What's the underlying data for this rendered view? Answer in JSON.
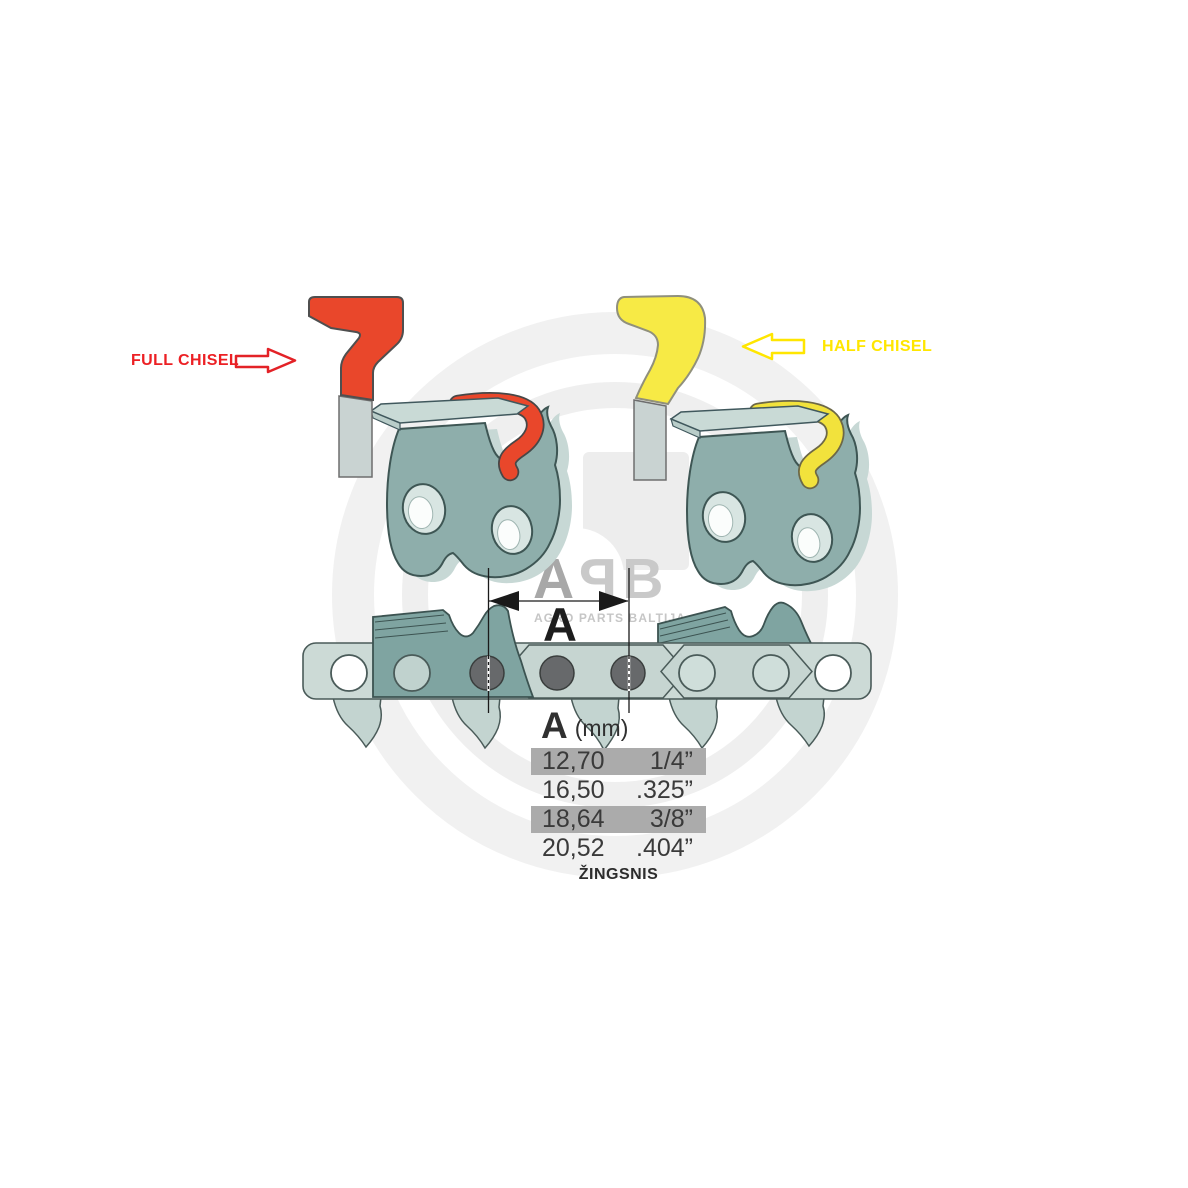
{
  "labels": {
    "full_chisel": "FULL CHISEL",
    "half_chisel": "HALF CHISEL",
    "dimension_letter": "A"
  },
  "pitch_table": {
    "header_symbol": "A",
    "header_unit": "(mm)",
    "rows": [
      {
        "mm": "12,70",
        "inch": "1/4”",
        "highlighted": true
      },
      {
        "mm": "16,50",
        "inch": ".325”",
        "highlighted": false
      },
      {
        "mm": "18,64",
        "inch": "3/8”",
        "highlighted": true
      },
      {
        "mm": "20,52",
        "inch": ".404”",
        "highlighted": false
      }
    ],
    "caption": "ŽINGSNIS"
  },
  "watermark": {
    "letters": [
      "A",
      "P",
      "B"
    ],
    "tagline": "AGRO PARTS BALTIJA"
  },
  "colors": {
    "full_chisel_red_text": "#EC2024",
    "chisel_red_fill": "#E9472B",
    "half_chisel_yellow_text": "#FFE600",
    "chisel_yellow_fill": "#F7EA45",
    "link_body_teal": "#8EAEAB",
    "chain_strap_teal": "#CCDAD6",
    "rivet_dark_gray": "#67696B",
    "row_highlight_gray": "#ABABAB",
    "table_text_gray": "#3A3A3A",
    "watermark_gray": "#C9C9C9"
  }
}
